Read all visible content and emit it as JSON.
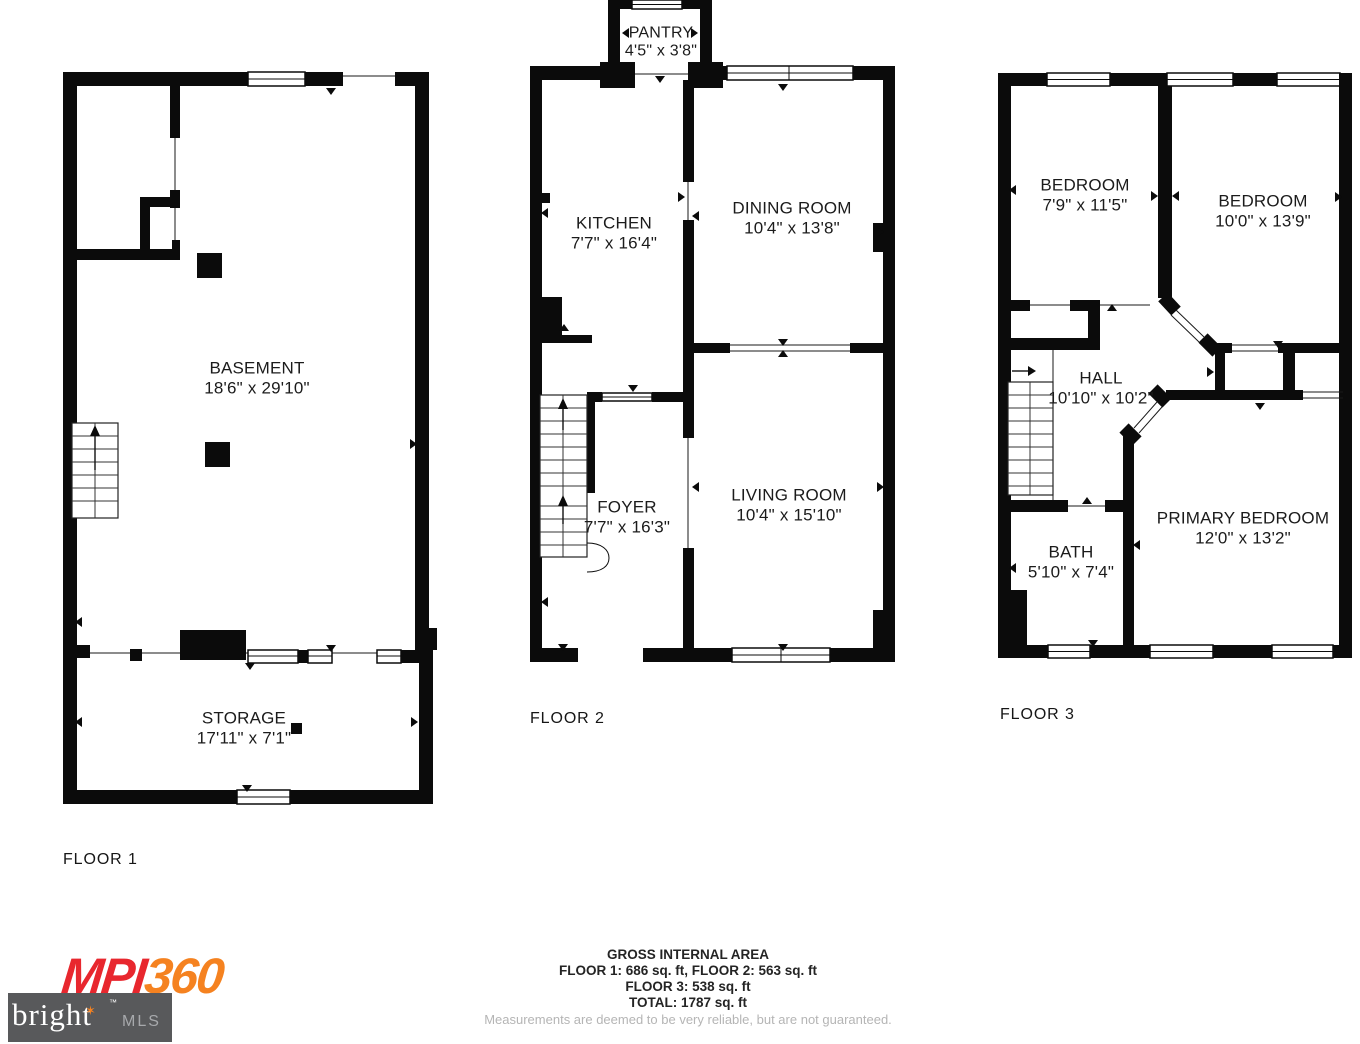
{
  "floors": [
    {
      "label": "FLOOR 1",
      "rooms": [
        {
          "name": "BASEMENT",
          "dims": "18'6\" x 29'10\""
        },
        {
          "name": "STORAGE",
          "dims": "17'11\" x 7'1\""
        }
      ]
    },
    {
      "label": "FLOOR 2",
      "rooms": [
        {
          "name": "PANTRY",
          "dims": "4'5\" x 3'8\""
        },
        {
          "name": "KITCHEN",
          "dims": "7'7\" x 16'4\""
        },
        {
          "name": "DINING ROOM",
          "dims": "10'4\" x 13'8\""
        },
        {
          "name": "FOYER",
          "dims": "7'7\" x 16'3\""
        },
        {
          "name": "LIVING ROOM",
          "dims": "10'4\" x 15'10\""
        }
      ]
    },
    {
      "label": "FLOOR 3",
      "rooms": [
        {
          "name": "BEDROOM",
          "dims": "7'9\" x 11'5\""
        },
        {
          "name": "BEDROOM",
          "dims": "10'0\" x 13'9\""
        },
        {
          "name": "HALL",
          "dims": "10'10\" x 10'2\""
        },
        {
          "name": "BATH",
          "dims": "5'10\" x 7'4\""
        },
        {
          "name": "PRIMARY BEDROOM",
          "dims": "12'0\" x 13'2\""
        }
      ]
    }
  ],
  "footer": {
    "title": "GROSS INTERNAL AREA",
    "line1": "FLOOR 1: 686 sq. ft, FLOOR 2: 563 sq. ft",
    "line2": "FLOOR 3: 538 sq. ft",
    "line3": "TOTAL: 1787 sq. ft",
    "disclaimer": "Measurements are deemed to be very reliable, but are not guaranteed."
  },
  "branding": {
    "mpi": "MPI",
    "threesixty": "360",
    "bright": "bright",
    "mls": "MLS",
    "tm": "™",
    "colors": {
      "mpi_red": "#e8272e",
      "mpi_orange": "#f58220",
      "bright_bg": "#58595b",
      "mls_gray": "#a7a9ac"
    }
  }
}
